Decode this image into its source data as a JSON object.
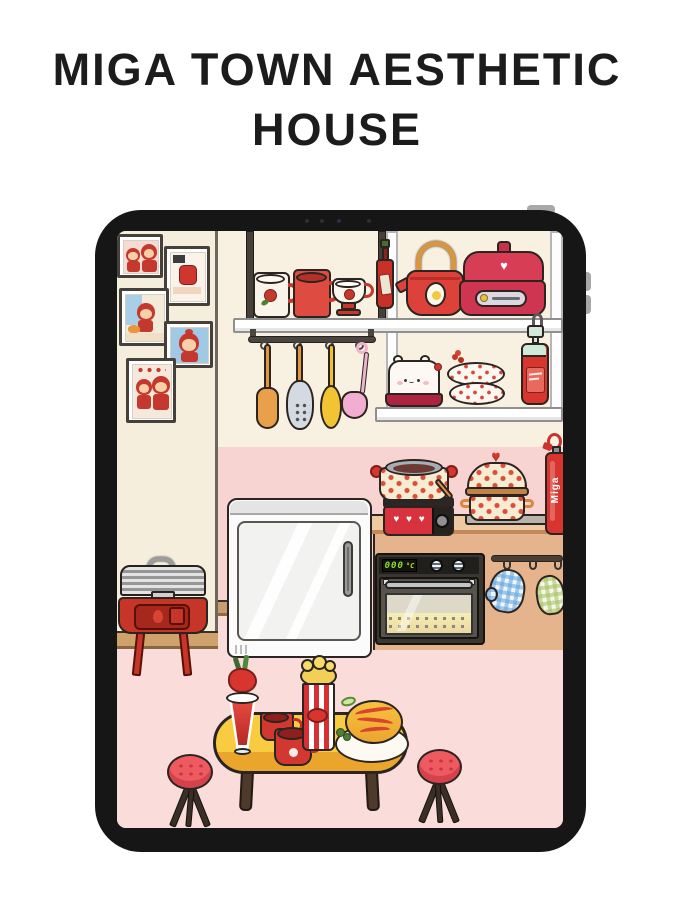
{
  "title": "MIGA TOWN AESTHETIC HOUSE",
  "tablet": {
    "oven": {
      "display_value": "000",
      "display_unit": "°C"
    },
    "fire_extinguisher_label": "Miga",
    "scene_items": [
      "framed-family-photos",
      "wall-shelves",
      "mug-white-rose",
      "mug-red",
      "teacup-red-rose",
      "hot-sauce-bottle",
      "red-teapot",
      "rice-cooker-heart",
      "hanging-utensils",
      "bear-toaster",
      "dotted-plates",
      "ketchup-pump-bottle",
      "portable-heart-stove",
      "soup-pot-dotted",
      "lidded-pot-dotted",
      "fire-extinguisher",
      "mini-fridge",
      "built-in-oven",
      "oven-mitts",
      "charcoal-grill",
      "yellow-dining-table",
      "berry-smoothie",
      "red-cup",
      "red-mug",
      "popcorn-box",
      "omurice-plate",
      "red-stool-left",
      "red-stool-right"
    ]
  },
  "icons": {
    "heart": "♥",
    "hearts_row": "♥ ♥ ♥"
  },
  "palette": {
    "accent_red": "#d8352f",
    "wall_cream": "#f8f1e2",
    "side_wall_cream": "#f5eedd",
    "wall_pink": "#f7d3d1",
    "floor_pink": "#fadcda",
    "baseboard_tan": "#c99d6d",
    "counter_tan": "#e5b48c",
    "table_yellow": "#f8cc41",
    "tablet_frame": "#161616",
    "oven_display_green": "#8fe034"
  }
}
